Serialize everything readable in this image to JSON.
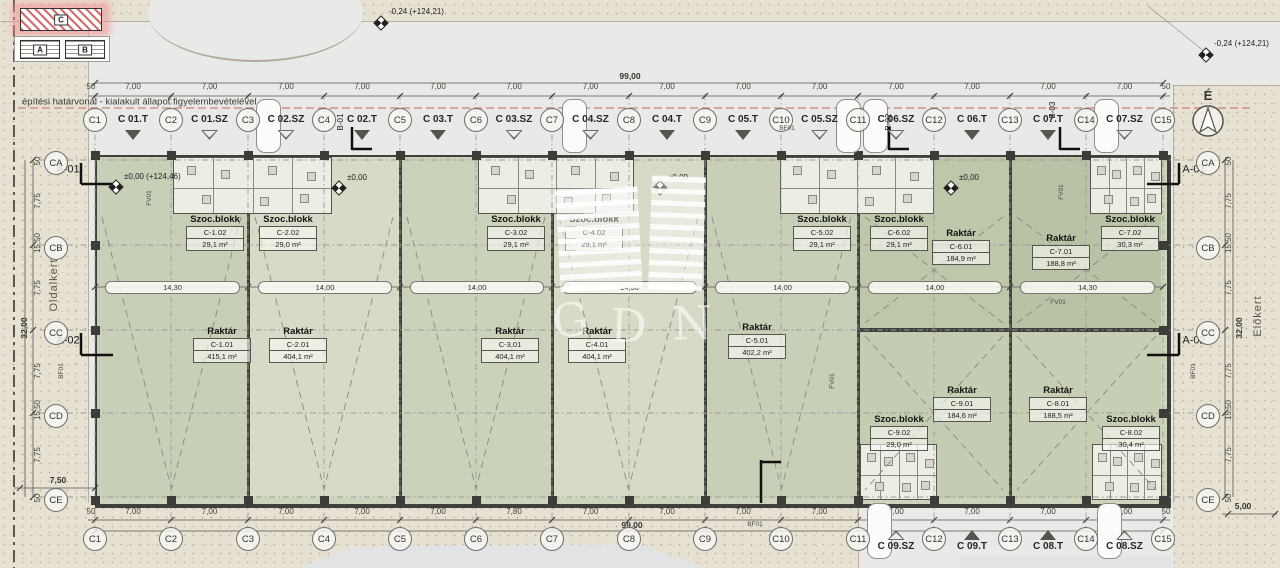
{
  "keyplan": {
    "block_a": "A",
    "block_b": "B",
    "block_c": "C"
  },
  "north": {
    "label": "É"
  },
  "watermark": {
    "letters": [
      "G",
      "D",
      "N"
    ]
  },
  "notes": {
    "boundary": "építési határvonal - kialakult állapot figyelembevételével",
    "side_yard": "Oldalkert",
    "front_yard": "Előkert"
  },
  "levels": {
    "top_center": "-0,24 (+124,21)",
    "top_right": "-0,24 (+124,21)",
    "main": "±0,00 (+124,46)",
    "zero": "±0,00"
  },
  "grid": {
    "columns": [
      "C1",
      "C2",
      "C3",
      "C4",
      "C5",
      "C6",
      "C7",
      "C8",
      "C9",
      "C10",
      "C11",
      "C12",
      "C13",
      "C14",
      "C15"
    ],
    "rows": [
      "CA",
      "CB",
      "CC",
      "CD",
      "CE"
    ]
  },
  "dimensions": {
    "total_width": "99,00",
    "total_height": "32,00",
    "end_offset": "50",
    "top_bays": [
      "7,00",
      "7,00",
      "7,00",
      "7,00",
      "7,00",
      "7,00",
      "7,00",
      "7,00",
      "7,00",
      "7,00",
      "7,00",
      "7,00",
      "7,00",
      "7,00"
    ],
    "bottom_bays": [
      "7,00",
      "7,00",
      "7,00",
      "7,00",
      "7,00",
      "7,80",
      "7,00",
      "7,00",
      "7,00",
      "7,00",
      "7,00",
      "7,00",
      "7,00",
      "7,00"
    ],
    "mid_bays": [
      "14,30",
      "14,00",
      "14,00",
      "14,00",
      "14,00",
      "14,00",
      "14,30"
    ],
    "left_col": [
      "50",
      "7,75",
      "15,50",
      "7,75",
      "7,75",
      "15,50",
      "7,75",
      "50"
    ],
    "right_col": [
      "50",
      "7,75",
      "15,50",
      "7,75",
      "7,75",
      "15,50",
      "7,75",
      "50"
    ],
    "side_left": "7,50",
    "side_right": "5,00"
  },
  "axis_refs": {
    "a01": "A-01",
    "a02": "A-02"
  },
  "section_marks": [
    "B-01",
    "B-02",
    "B-03"
  ],
  "small_labels": {
    "fv": "FV01",
    "bf": "BF01"
  },
  "entries_top": [
    {
      "label": "C 01.T",
      "gate": "filled"
    },
    {
      "label": "C 01.SZ",
      "gate": "open"
    },
    {
      "label": "C 02.SZ",
      "gate": "open"
    },
    {
      "label": "C 02.T",
      "gate": "filled"
    },
    {
      "label": "C 03.T",
      "gate": "filled"
    },
    {
      "label": "C 03.SZ",
      "gate": "open"
    },
    {
      "label": "C 04.SZ",
      "gate": "open"
    },
    {
      "label": "C 04.T",
      "gate": "filled"
    },
    {
      "label": "C 05.T",
      "gate": "filled"
    },
    {
      "label": "C 05.SZ",
      "gate": "open"
    },
    {
      "label": "C 06.SZ",
      "gate": "open"
    },
    {
      "label": "C 06.T",
      "gate": "filled"
    },
    {
      "label": "C 07.T",
      "gate": "filled"
    },
    {
      "label": "C 07.SZ",
      "gate": "open"
    }
  ],
  "entries_bottom": [
    {
      "label": "C 09.SZ",
      "gate": "open"
    },
    {
      "label": "C 09.T",
      "gate": "filled"
    },
    {
      "label": "C 08.T",
      "gate": "filled"
    },
    {
      "label": "C 08.SZ",
      "gate": "open"
    }
  ],
  "rooms": [
    {
      "kind": "Raktár",
      "code": "C-1.01",
      "area": "415,1 m²"
    },
    {
      "kind": "Raktár",
      "code": "C-2.01",
      "area": "404,1 m²"
    },
    {
      "kind": "Raktár",
      "code": "C-3.01",
      "area": "404,1 m²"
    },
    {
      "kind": "Raktár",
      "code": "C-4.01",
      "area": "404,1 m²"
    },
    {
      "kind": "Raktár",
      "code": "C-5.01",
      "area": "402,2 m²"
    },
    {
      "kind": "Raktár",
      "code": "C-6.01",
      "area": "184,9 m²"
    },
    {
      "kind": "Raktár",
      "code": "C-7.01",
      "area": "188,8 m²"
    },
    {
      "kind": "Raktár",
      "code": "C-9.01",
      "area": "184,6 m²"
    },
    {
      "kind": "Raktár",
      "code": "C-8.01",
      "area": "188,5 m²"
    },
    {
      "kind": "Szoc.blokk",
      "code": "C-1.02",
      "area": "29,1 m²"
    },
    {
      "kind": "Szoc.blokk",
      "code": "C-2.02",
      "area": "29,0 m²"
    },
    {
      "kind": "Szoc.blokk",
      "code": "C-3.02",
      "area": "29,1 m²"
    },
    {
      "kind": "Szoc.blokk",
      "code": "C-4.02",
      "area": "29,1 m²"
    },
    {
      "kind": "Szoc.blokk",
      "code": "C-5.02",
      "area": "29,1 m²"
    },
    {
      "kind": "Szoc.blokk",
      "code": "C-6.02",
      "area": "29,1 m²"
    },
    {
      "kind": "Szoc.blokk",
      "code": "C-7.02",
      "area": "30,3 m²"
    },
    {
      "kind": "Szoc.blokk",
      "code": "C-9.02",
      "area": "29,0 m²"
    },
    {
      "kind": "Szoc.blokk",
      "code": "C-8.02",
      "area": "30,4 m²"
    }
  ]
}
